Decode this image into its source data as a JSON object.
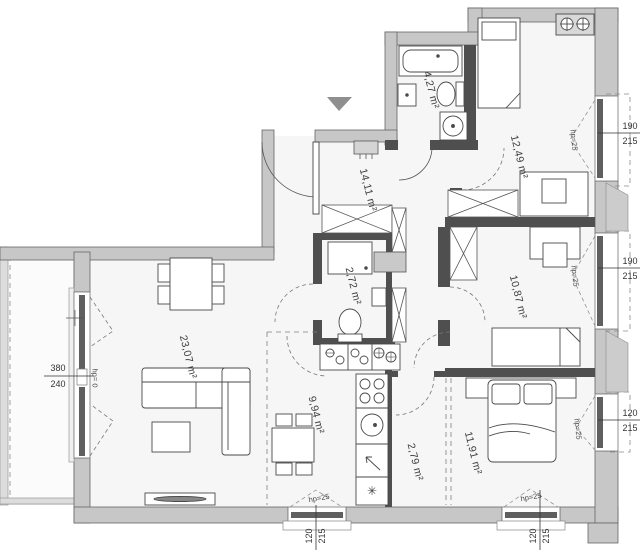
{
  "rooms": {
    "living": {
      "label": "23,07 m²"
    },
    "kitchen": {
      "label": "9,94 m²"
    },
    "hall": {
      "label": "14,11 m²"
    },
    "wc": {
      "label": "2,72 m²"
    },
    "bath": {
      "label": "4,27 m²"
    },
    "bed1": {
      "label": "12,49 m²"
    },
    "bed2": {
      "label": "10,87 m²"
    },
    "bed3": {
      "label": "11,91 m²"
    },
    "storage": {
      "label": "2,79 m²"
    }
  },
  "windows": {
    "left": {
      "w": "380",
      "h": "240",
      "hp": "hp= 0"
    },
    "right_top": {
      "w": "190",
      "h": "215",
      "hp": "hp=25"
    },
    "right_middle": {
      "w": "190",
      "h": "215",
      "hp": "hp=25"
    },
    "right_bottom": {
      "w": "120",
      "h": "215",
      "hp": "hp=25"
    },
    "bottom_kitchen": {
      "w": "120",
      "h": "215",
      "hp": "hp=25"
    },
    "bottom_bedroom": {
      "w": "120",
      "h": "215",
      "hp": "hp=25"
    }
  },
  "icons": {
    "freezer_symbol": "✳"
  },
  "colors": {
    "wall_fill": "#c7c7c7",
    "wall_dark": "#4f4f4f",
    "floor": "#f6f6f6",
    "line": "#4a4a4a",
    "dashed": "#808080",
    "entrance_marker": "#8f8f8f",
    "duct_fill": "#c9c9c9"
  }
}
